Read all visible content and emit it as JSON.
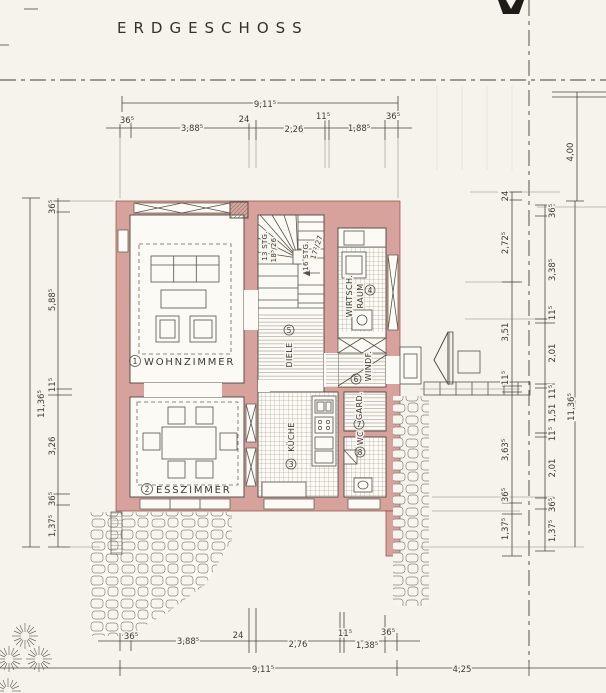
{
  "title": "ERDGESCHOSS",
  "colors": {
    "paper": "#f5f3ec",
    "wall_fill": "#d8a29c",
    "wall_edge": "#8d4a42",
    "ink": "#3c3a35",
    "hatch": "#8f8a7f"
  },
  "rooms": {
    "wohnzimmer": {
      "num": "1",
      "name": "WOHNZIMMER"
    },
    "esszimmer": {
      "num": "2",
      "name": "ESSZIMMER"
    },
    "kueche": {
      "num": "3",
      "name": "KÜCHE"
    },
    "wirtschaftsraum": {
      "num": "4",
      "name": "WIRTSCH.",
      "name2": "RAUM"
    },
    "diele": {
      "num": "5",
      "name": "DIELE"
    },
    "windfang": {
      "num": "6",
      "name": "WINDF."
    },
    "garderobe": {
      "num": "7",
      "name": "GARD."
    },
    "wc": {
      "num": "8",
      "name": "WC"
    }
  },
  "stairs": {
    "flight1_count": "13 STG.",
    "flight1_step": "18⁵/26",
    "flight2_count": "16 STG.",
    "flight2_step": "17²/27"
  },
  "dimensions": {
    "top": {
      "overall": "9,11⁵",
      "segments": [
        "36⁵",
        "3,88⁵",
        "24",
        "2,26",
        "11⁵",
        "1,88⁵",
        "36⁵"
      ]
    },
    "bottom": {
      "overall": "9,11⁵",
      "offset_right": "4,25",
      "segments": [
        "36⁵",
        "3,88⁵",
        "24",
        "2,76",
        "11⁵",
        "1,38⁵",
        "36⁵"
      ]
    },
    "left": {
      "overall": "11,36⁵",
      "segments": [
        "36⁵",
        "5,88⁵",
        "11⁵",
        "3,26",
        "36⁵",
        "1,37⁵"
      ]
    },
    "right_inner": {
      "segments": [
        "24",
        "2,72⁵",
        "3,51",
        "11⁵",
        "3,63⁵",
        "36⁵",
        "1,37⁵"
      ]
    },
    "right_outer": {
      "overall": "11,36⁵",
      "setback": "4,00",
      "segments": [
        "36⁵",
        "3,38⁵",
        "11⁵",
        "2,01",
        "11⁵",
        "1,51",
        "11⁵",
        "2,01",
        "36⁵",
        "1,37⁵"
      ]
    }
  }
}
